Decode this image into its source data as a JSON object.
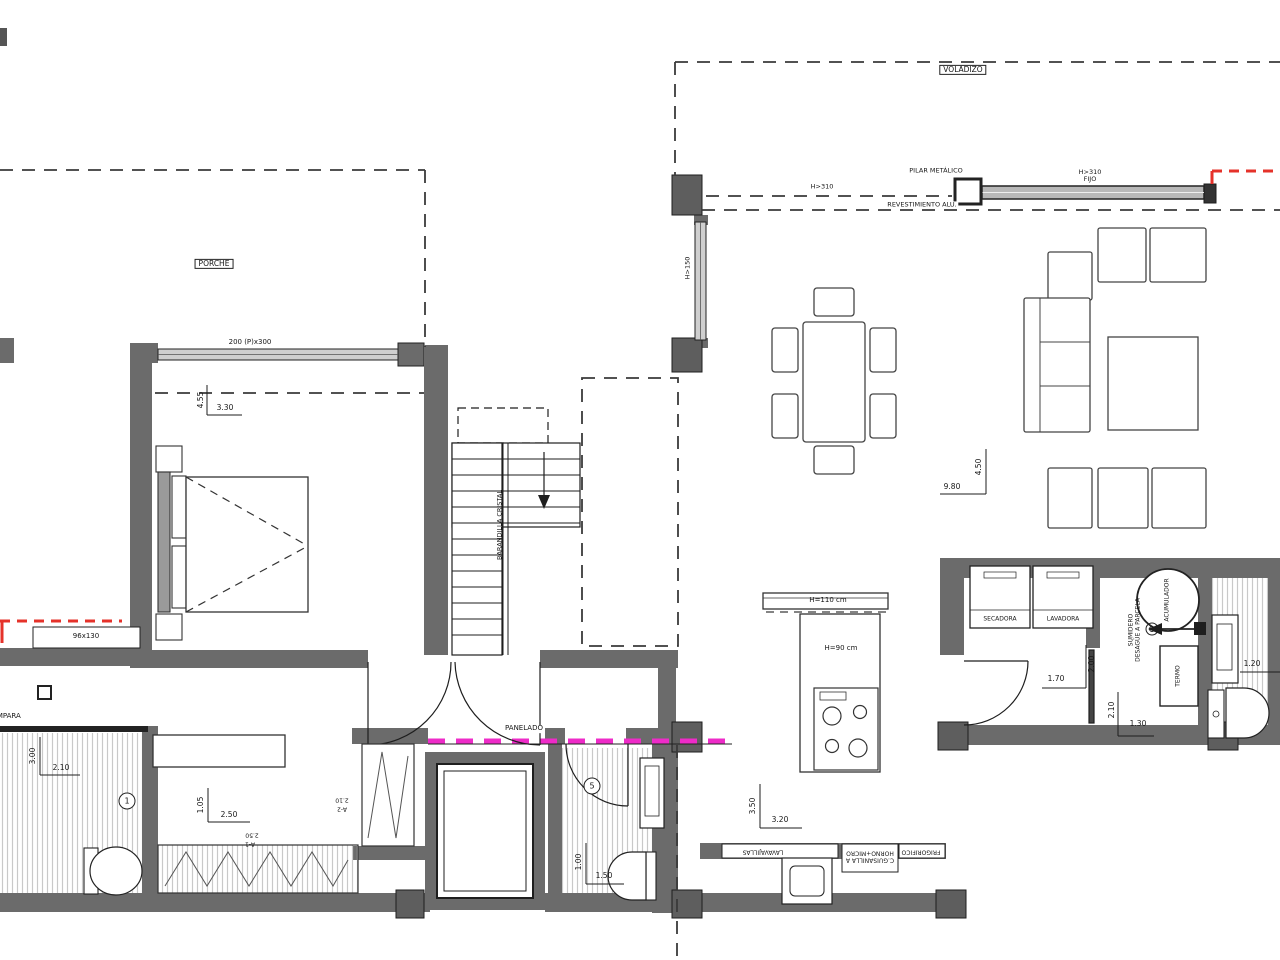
{
  "colors": {
    "wall": "#6b6b6b",
    "column": "#5e5e5e",
    "line": "#1e1e1e",
    "red_accent": "#e5322a",
    "magenta_accent": "#ee2bc8",
    "hatch": "#c9c9c9"
  },
  "labels": {
    "voladizo": "VOLADIZO",
    "h310": "H>310",
    "pilar_metalico": "PILAR METÁLICO",
    "fijo_line1": "H>310",
    "fijo_line2": "FIJO",
    "revestimiento": "REVESTIMIENTO ALU.",
    "porche": "PORCHE",
    "window_bedroom": "200 (P)x300",
    "h150": "H>150",
    "barandilla": "BARANDILLA CRISTAL",
    "panelado": "PANELADO",
    "bar_height": "H=110 cm",
    "island_height": "H=90 cm",
    "secadora": "SECADORA",
    "lavadora": "LAVADORA",
    "acumulador": "ACUMULADOR",
    "sumidero_line1": "SUMIDERO",
    "sumidero_line2": "DESAGÜE A PARCELA",
    "termo": "TERMO",
    "mampara": "MAMPARA",
    "window_bath": "96x130",
    "kitchen_left": "LAVAVAJILLAS",
    "kitchen_mid_line1": "C.GUISANILLA A",
    "kitchen_mid_line2": "HORNO+MICRO",
    "kitchen_right": "FRIGORIFICO"
  },
  "dims": {
    "bedroom_h": "4.55",
    "bedroom_w": "3.30",
    "living_w": "9.80",
    "living_h": "4.50",
    "bath_left_h": "3.00",
    "bath_left_w": "2.10",
    "dressing_h": "1.05",
    "dressing_w": "2.50",
    "dressing_w2": "2.50",
    "ref_a1": "A-1",
    "shaft_w": "2.10",
    "ref_a2": "A-2",
    "bath_center_h": "1.00",
    "bath_center_w": "1.50",
    "kitchen_h": "3.50",
    "kitchen_w": "3.20",
    "laundry_w": "1.70",
    "laundry_h": "2.00",
    "boiler_h": "2.10",
    "boiler_w": "1.30",
    "bath_right_w": "1.20",
    "circle_1": "1",
    "circle_5": "5"
  }
}
